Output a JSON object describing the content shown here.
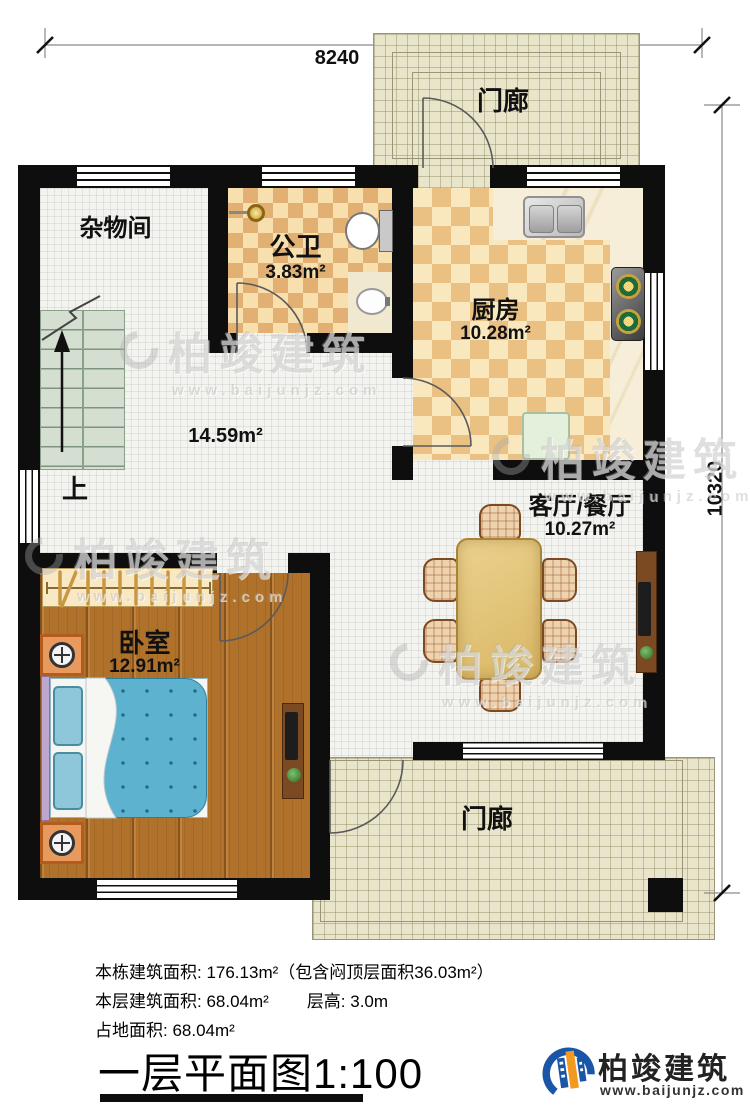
{
  "dimensions": {
    "top": "8240",
    "right": "10320"
  },
  "rooms": {
    "porch_top": {
      "label": "门廊"
    },
    "storage": {
      "label": "杂物间"
    },
    "bathroom": {
      "label": "公卫",
      "area": "3.83m²"
    },
    "kitchen": {
      "label": "厨房",
      "area": "10.28m²"
    },
    "hall": {
      "area": "14.59m²"
    },
    "living": {
      "label": "客厅/餐厅",
      "area": "10.27m²"
    },
    "bedroom": {
      "label": "卧室",
      "area": "12.91m²"
    },
    "porch_bottom": {
      "label": "门廊"
    },
    "stairs": {
      "label": "上"
    }
  },
  "watermark": {
    "brand": "柏竣建筑",
    "site": "www.baijunjz.com"
  },
  "notes": {
    "line1": "本栋建筑面积: 176.13m²（包含闷顶层面积36.03m²）",
    "line2a": "本层建筑面积: 68.04m²",
    "line2b": "层高: 3.0m",
    "line3": "占地面积: 68.04m²"
  },
  "title": "一层平面图1:100",
  "logo": {
    "brand": "柏竣建筑",
    "site": "www.baijunjz.com"
  }
}
